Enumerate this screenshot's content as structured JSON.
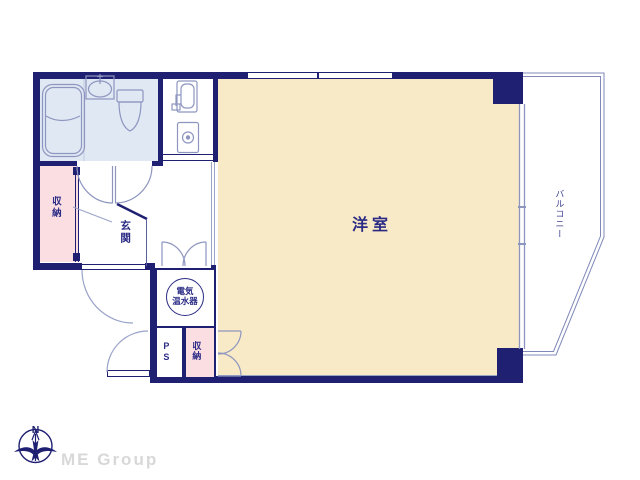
{
  "rooms": {
    "western_room_label": "洋室",
    "balcony_label": "バルコニー",
    "entrance_label": "玄関",
    "closet_left_label": "収納",
    "closet_bottom_label": "収納",
    "pipe_space_label": "PS",
    "water_heater": {
      "line1": "電気",
      "line2": "温水器"
    }
  },
  "compass": {
    "north_label": "N"
  },
  "branding": {
    "logo_text": "ME Group"
  },
  "colors": {
    "wall": "#1f2071",
    "room_fill": "#f8e9c7",
    "closet_fill": "#fadee2",
    "bathroom_fill": "#dfe8f3",
    "fixture_stroke": "#8e96c0",
    "label_text": "#2b2b85",
    "logo_text": "#d8d8d8"
  }
}
